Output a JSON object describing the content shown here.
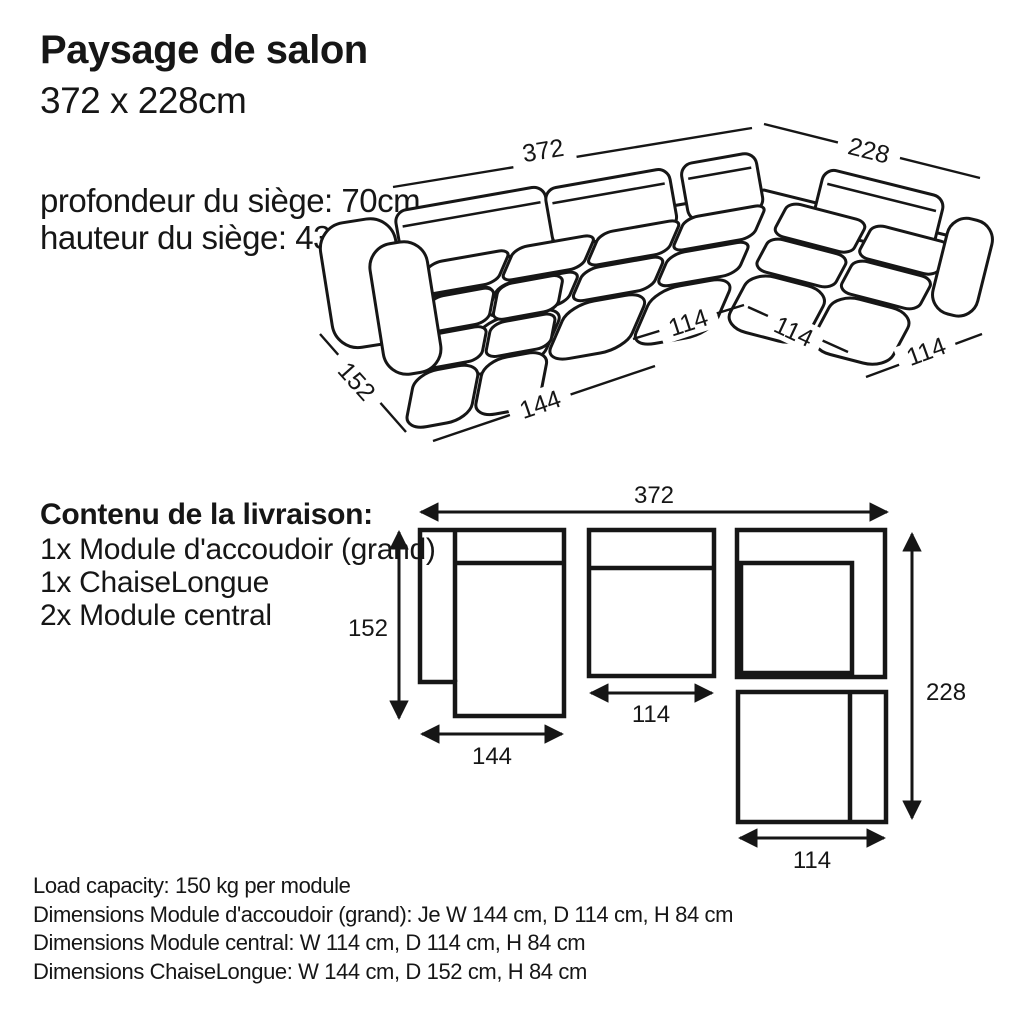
{
  "colors": {
    "ink": "#161616",
    "paper": "#ffffff"
  },
  "header": {
    "title": "Paysage de salon",
    "subtitle": "372 x 228cm"
  },
  "seat_info": {
    "depth_line": "profondeur du siège: 70cm",
    "height_line": "hauteur du siège: 43cm"
  },
  "sofa_dims": {
    "total_width": "372",
    "total_depth": "228",
    "chaise_depth": "152",
    "chaise_width": "144",
    "module_a": "114",
    "module_b": "114",
    "module_c": "114"
  },
  "delivery": {
    "heading": "Contenu de la livraison:",
    "items": [
      "1x Module d'accoudoir (grand)",
      "1x ChaiseLongue",
      "2x Module central"
    ]
  },
  "plan_dims": {
    "total_width": "372",
    "chaise_depth": "152",
    "chaise_width": "144",
    "module_width": "114",
    "total_depth": "228",
    "corner_width": "114"
  },
  "specs": [
    "Load capacity: 150 kg per module",
    "Dimensions Module d'accoudoir (grand): Je W 144 cm, D 114 cm, H 84 cm",
    "Dimensions Module central: W 114 cm, D 114 cm, H 84 cm",
    "Dimensions ChaiseLongue: W 144 cm, D 152 cm, H 84 cm"
  ]
}
